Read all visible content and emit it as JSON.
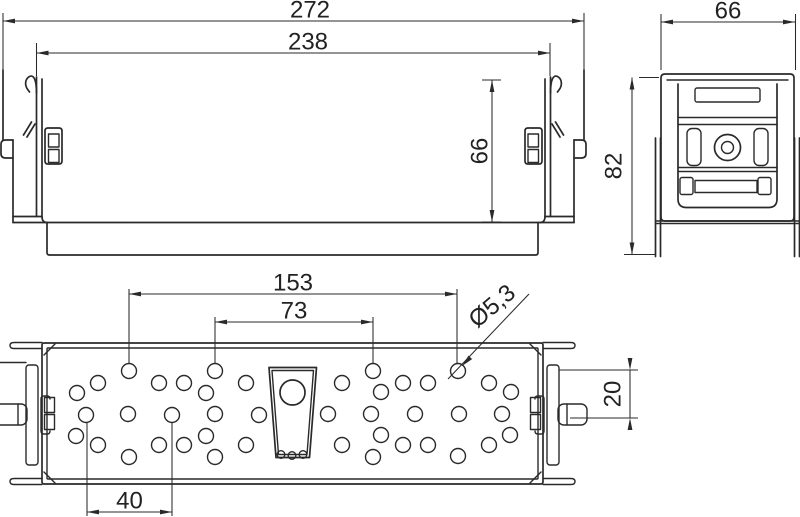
{
  "colors": {
    "background": "#ffffff",
    "line": "#2a2a2a"
  },
  "front_view": {
    "dim_outer_width": "272",
    "dim_cover_width": "238",
    "dim_height": "66"
  },
  "side_view": {
    "dim_width": "66",
    "dim_height": "82"
  },
  "plan_view": {
    "dim_hole_span_outer": "153",
    "dim_hole_span_inner": "73",
    "dim_hole_diameter": "Ø5,3",
    "dim_tab_offset": "20",
    "dim_hole_pitch": "40",
    "holes": {
      "radius": 7.5,
      "centers": [
        [
          129,
          371
        ],
        [
          215,
          371
        ],
        [
          373,
          371
        ],
        [
          458,
          371
        ],
        [
          98,
          383
        ],
        [
          159,
          383
        ],
        [
          184,
          383
        ],
        [
          246,
          383
        ],
        [
          342,
          383
        ],
        [
          403,
          383
        ],
        [
          428,
          383
        ],
        [
          489,
          383
        ],
        [
          77,
          393
        ],
        [
          206,
          393
        ],
        [
          381,
          392
        ],
        [
          511,
          392
        ],
        [
          86,
          415
        ],
        [
          128,
          414
        ],
        [
          172,
          415
        ],
        [
          215,
          414
        ],
        [
          259,
          415
        ],
        [
          328,
          414
        ],
        [
          371,
          414
        ],
        [
          415,
          414
        ],
        [
          459,
          414
        ],
        [
          502,
          414
        ],
        [
          76,
          436
        ],
        [
          206,
          436
        ],
        [
          381,
          435
        ],
        [
          510,
          435
        ],
        [
          98,
          445
        ],
        [
          159,
          445
        ],
        [
          184,
          445
        ],
        [
          246,
          445
        ],
        [
          342,
          445
        ],
        [
          403,
          445
        ],
        [
          428,
          445
        ],
        [
          489,
          445
        ],
        [
          129,
          457
        ],
        [
          215,
          457
        ],
        [
          373,
          457
        ],
        [
          458,
          456
        ]
      ]
    }
  }
}
